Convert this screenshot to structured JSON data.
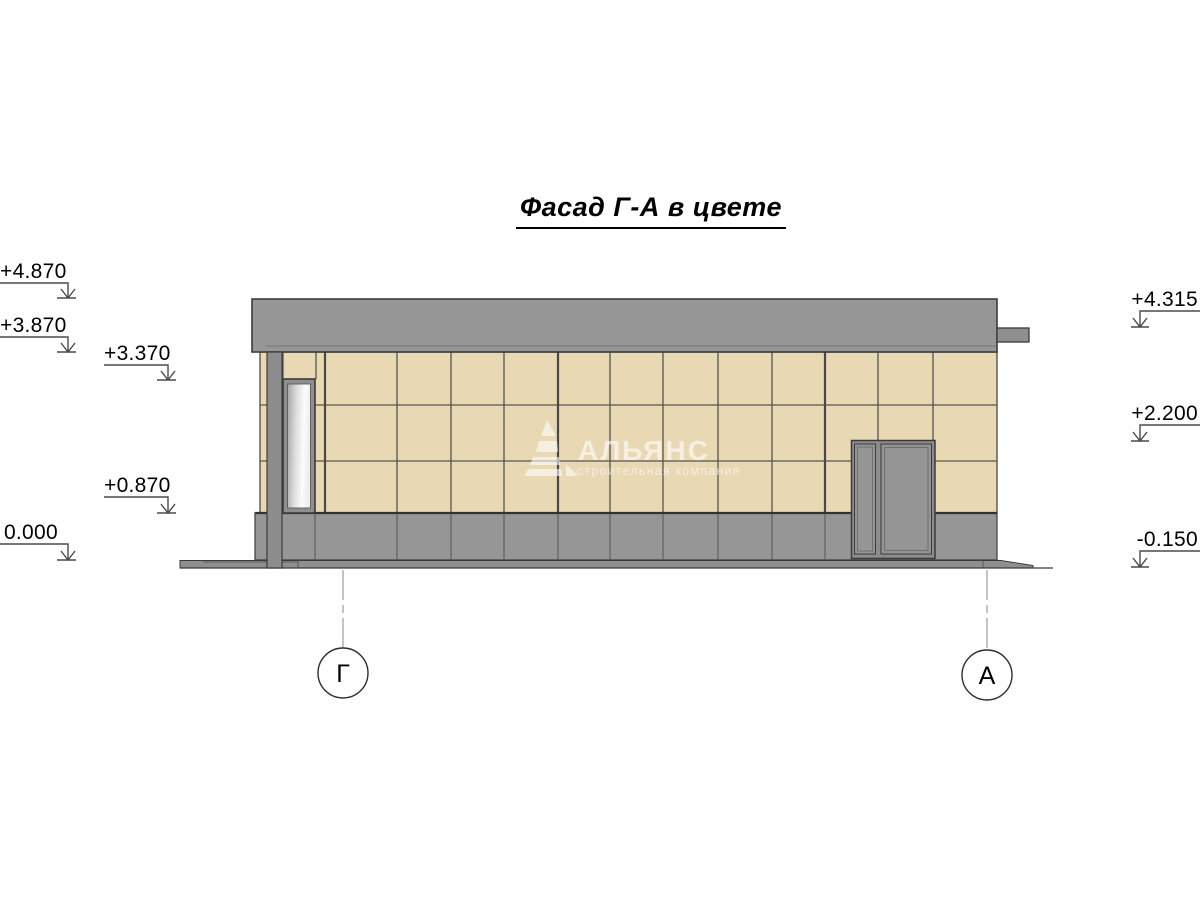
{
  "title": "Фасад Г-А в цвете",
  "elevation_marks": {
    "left": [
      {
        "value": "+4.870"
      },
      {
        "value": "+3.870"
      },
      {
        "value": "+3.370"
      },
      {
        "value": "+0.870"
      },
      {
        "value": "0.000"
      }
    ],
    "right": [
      {
        "value": "+4.315"
      },
      {
        "value": "+2.200"
      },
      {
        "value": "-0.150"
      }
    ]
  },
  "axis_markers": [
    {
      "label": "Г"
    },
    {
      "label": "А"
    }
  ],
  "watermark": {
    "name": "АЛЬЯНС",
    "subtitle": "строительная компания"
  },
  "colors": {
    "tile": "#e9d8b4",
    "concrete": "#969696",
    "concrete_dark": "#8f8f8f",
    "door_leaf": "#959595",
    "outline": "#3c3c3c",
    "grid_line": "#57554e",
    "glass_dark": "#a4a4a4",
    "glass_light": "#fcfcfc"
  }
}
